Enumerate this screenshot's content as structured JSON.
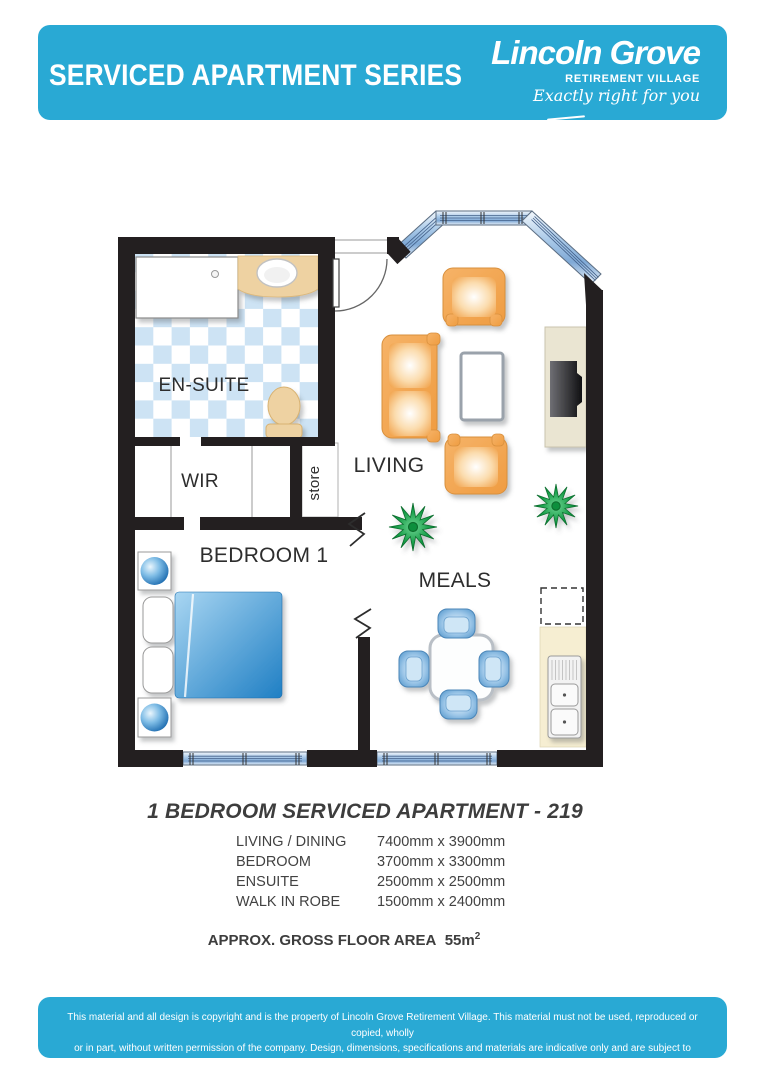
{
  "header": {
    "series_title": "SERVICED APARTMENT SERIES",
    "brand_name": "Lincoln Grove",
    "brand_subtitle": "RETIREMENT VILLAGE",
    "brand_tagline": "Exactly right for you"
  },
  "plan": {
    "labels": {
      "ensuite": "EN-SUITE",
      "wir": "WIR",
      "store": "store",
      "living": "LIVING",
      "bedroom": "BEDROOM 1",
      "meals": "MEALS"
    }
  },
  "details": {
    "title": "1 BEDROOM SERVICED APARTMENT - 219",
    "dimensions": [
      {
        "room": "LIVING / DINING",
        "size": "7400mm x 3900mm"
      },
      {
        "room": "BEDROOM",
        "size": "3700mm x 3300mm"
      },
      {
        "room": "ENSUITE",
        "size": "2500mm x 2500mm"
      },
      {
        "room": "WALK IN ROBE",
        "size": "1500mm x 2400mm"
      }
    ],
    "area_label": "APPROX. GROSS FLOOR AREA",
    "area_value": "55m",
    "area_sup": "2"
  },
  "footer": {
    "line1": "This material and all design is copyright and is the property of Lincoln Grove Retirement Village. This material must not be used, reproduced or copied, wholly",
    "line2": "or in part, without written permission of the company. Design, dimensions, specifications and materials are indicative only and are subject to change without notice."
  },
  "colors": {
    "brand_blue": "#29a9d4",
    "wall_black": "#231f20",
    "tile_blue": "#cde3f4",
    "sofa_orange": "#f2a24a",
    "bed_blue": "#2d88c9",
    "plant_green": "#129a44",
    "counter_beige": "#f6eed2",
    "fixture_tan": "#eed2a2"
  }
}
